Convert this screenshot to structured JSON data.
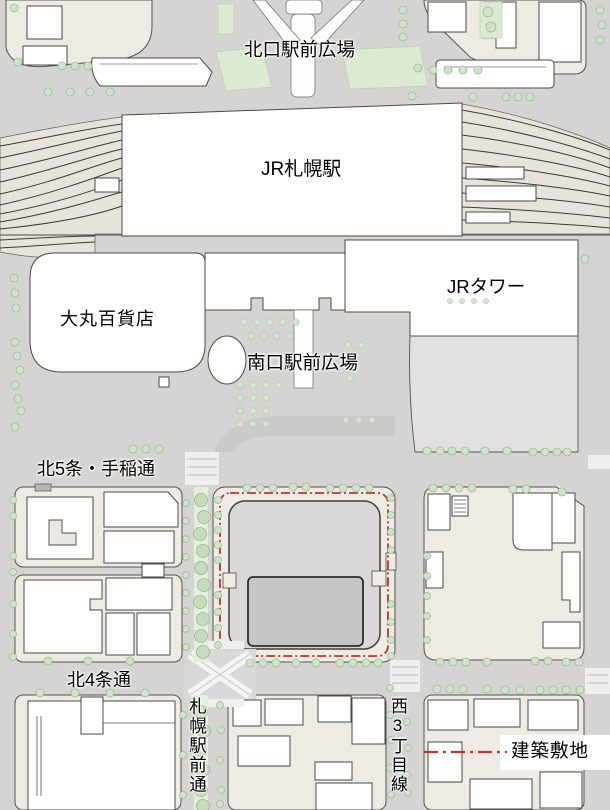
{
  "map": {
    "labels": {
      "north_plaza": "北口駅前広場",
      "station": "JR札幌駅",
      "daimaru": "大丸百貨店",
      "jr_tower": "JRタワー",
      "south_plaza": "南口駅前広場",
      "kita5_teine_street": "北5条・手稲通",
      "kita4_street": "北4条通",
      "sapporo_ekimae_street": "札幌駅前通",
      "nishi3chome_line": "西3丁目線"
    },
    "legend": {
      "site_label": "建築敷地",
      "boundary_color": "#b5392e",
      "boundary_style": "dash-dot"
    },
    "colors": {
      "street": "#d5d4d2",
      "block": "#edebe3",
      "rail_bed": "#e7e3da",
      "building": "#ffffff",
      "site_pad": "#d9d8d6",
      "building_footprint": "#c7c6c4",
      "tree_fill": "#cfe3cb",
      "median_green": "#e3efdb",
      "outline": "#4a4a48"
    }
  }
}
